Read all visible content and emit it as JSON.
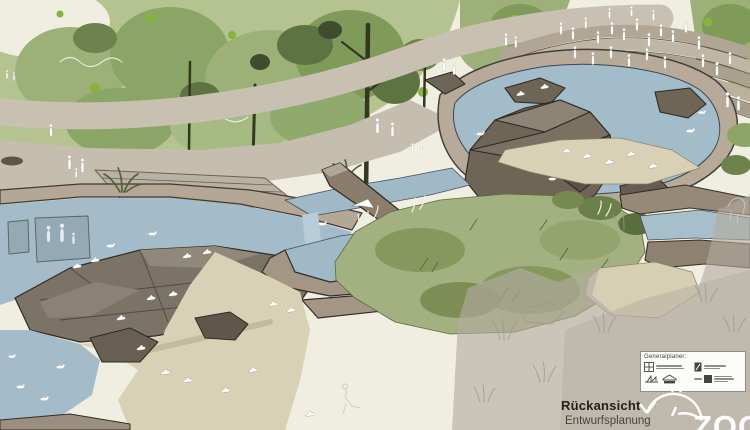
{
  "annotations": {
    "view_label": "Rückansicht",
    "phase_label": "Entwurfsplanung"
  },
  "title_block": {
    "heading": "Generalplaner:",
    "logos": [
      {
        "icon": "window-grid-logo"
      },
      {
        "icon": "door-panel-logo"
      },
      {
        "icon": "sailboat-logo"
      },
      {
        "icon": "house-banner-logo"
      },
      {
        "icon": "itec-square-logo"
      }
    ]
  },
  "zoo_logo": {
    "text": "ZOO",
    "icon": "dolphin-icon"
  },
  "palette": {
    "sky": "#f0ede1",
    "tree_light": "#b5c391",
    "tree_mid": "#9cb077",
    "tree_dark": "#5e7342",
    "path": "#c8c1b2",
    "wall": "#b5a795",
    "water": "#a3bcc9",
    "rock": "#6e6557",
    "sand": "#d8d1b5",
    "grass": "#a3b181",
    "faded_overlay": "#b3aba0",
    "figure_white": "#ffffff",
    "accent_green": "#86b33c"
  }
}
